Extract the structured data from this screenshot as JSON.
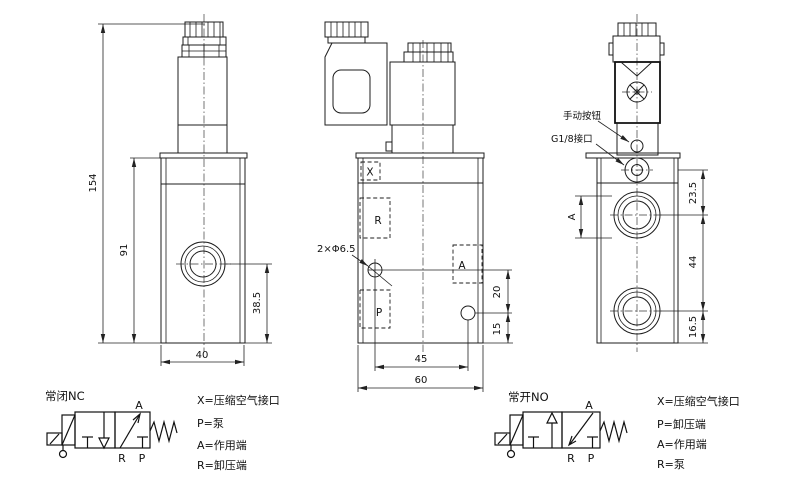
{
  "front_view": {
    "dim_total_height": "154",
    "dim_body_height": "91",
    "dim_port_height": "38.5",
    "dim_width": "40"
  },
  "side_view": {
    "port_x": "X",
    "port_r": "R",
    "port_a": "A",
    "port_p": "P",
    "mount_holes_label": "2×Φ6.5",
    "dim_hole_spacing": "45",
    "dim_width": "60",
    "dim_upper": "20",
    "dim_lower": "15"
  },
  "end_view": {
    "manual_button_label": "手动按钮",
    "g18_label": "G1/8接口",
    "dim_top": "23.5",
    "dim_mid": "44",
    "dim_bottom": "16.5",
    "port_a_label": "A"
  },
  "schematic_nc": {
    "title": "常闭NC",
    "port_a": "A",
    "port_r": "R",
    "port_p": "P"
  },
  "schematic_no": {
    "title": "常开NO",
    "port_a": "A",
    "port_r": "R",
    "port_p": "P"
  },
  "legend_nc": {
    "items": [
      "X=压缩空气接口",
      "P=泵",
      "A=作用端",
      "R=卸压端"
    ]
  },
  "legend_no": {
    "items": [
      "X=压缩空气接口",
      "P=卸压端",
      "A=作用端",
      "R=泵"
    ]
  },
  "colors": {
    "line": "#1c1c1c",
    "background": "#ffffff"
  }
}
